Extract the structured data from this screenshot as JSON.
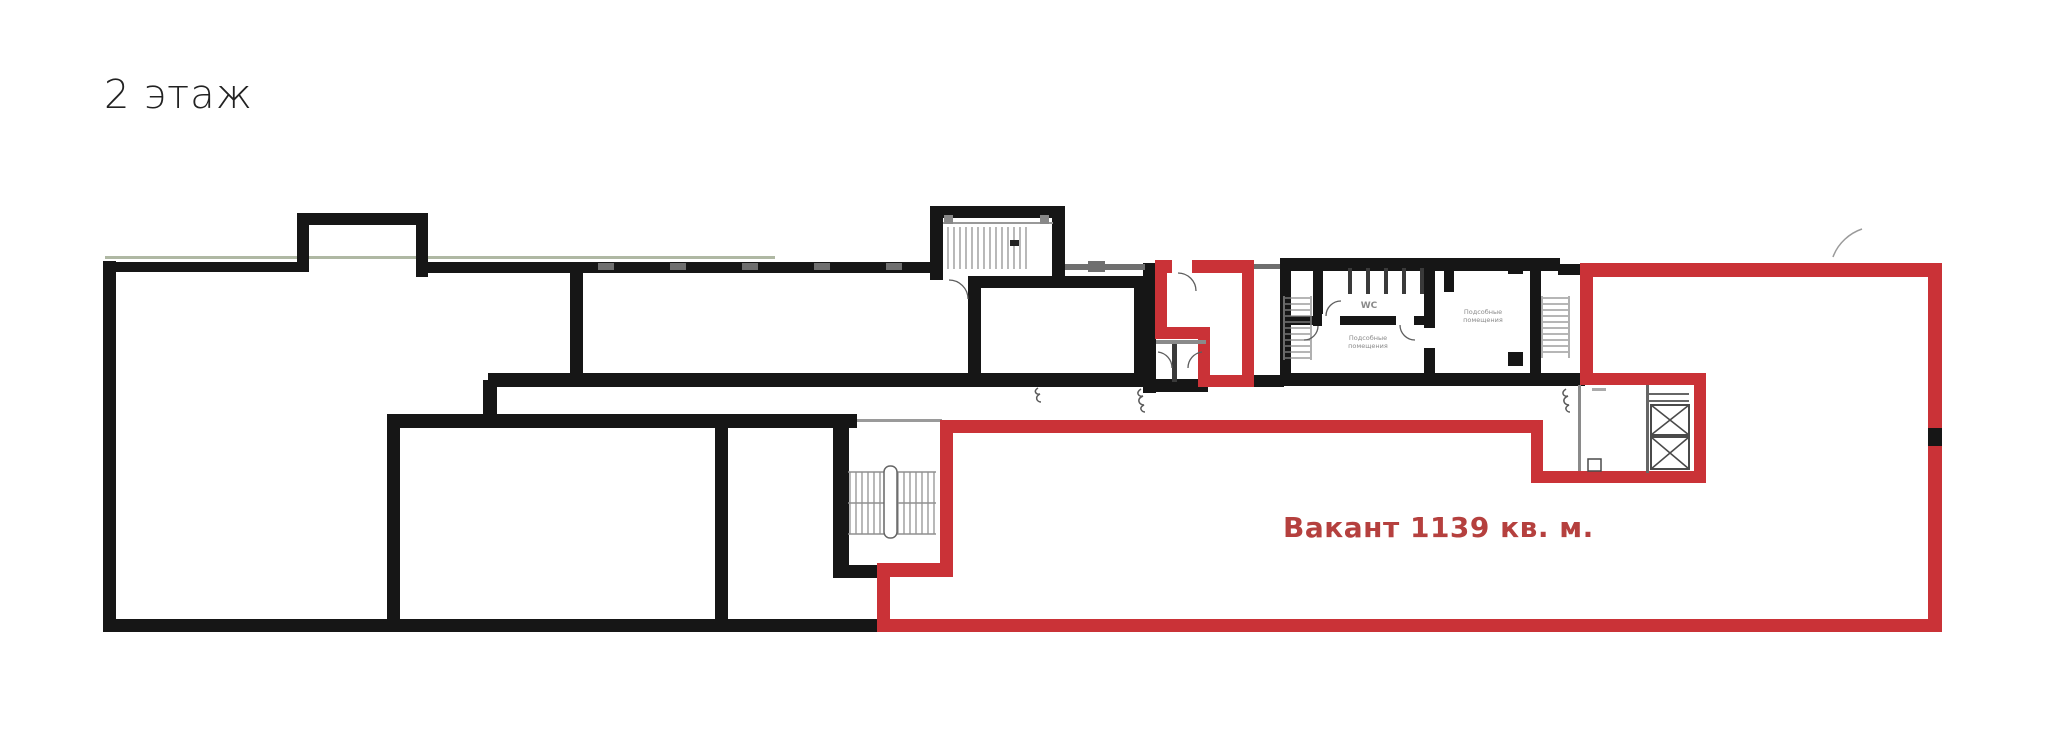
{
  "page": {
    "title": "2 этаж"
  },
  "plan": {
    "type": "floor-plan",
    "floor": "2",
    "vacant": {
      "label": "Вакант 1139 кв. м.",
      "area_sqm": "1139"
    },
    "rooms": {
      "wc_label": "WC",
      "utility_room_1": "Подсобные помещения",
      "utility_room_2": "Подсобные помещения"
    },
    "colors": {
      "wall": "#161616",
      "red": "#ca3237",
      "label-red": "#b5403e",
      "label-gray": "#8a8a8a"
    }
  }
}
